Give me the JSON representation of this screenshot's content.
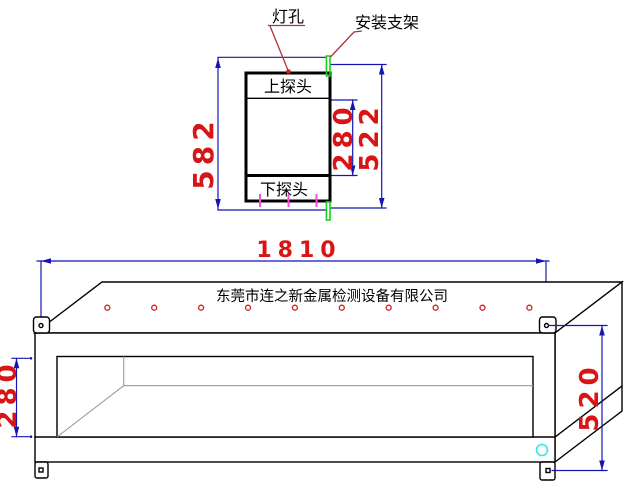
{
  "section_view": {
    "labels": {
      "lamp_hole": "灯孔",
      "mounting_bracket": "安装支架",
      "upper_probe": "上探头",
      "lower_probe": "下探头"
    },
    "dimensions": {
      "overall_height": "582",
      "mount_span": "522",
      "probe_spacing": "280"
    }
  },
  "perspective_view": {
    "company_name": "东莞市连之新金属检测设备有限公司",
    "dimensions": {
      "overall_length": "1810",
      "tunnel_height": "280",
      "overall_height": "520"
    },
    "lamp_hole_count": 10
  },
  "colors": {
    "dimension_line": "#1515b5",
    "dimension_text": "#d91414",
    "leader_line": "#b03434",
    "outline": "#000000",
    "interior_line": "#9a9a9a",
    "bracket_mark": "#19d119",
    "tick_mark": "#f050e0",
    "lamp_hole": "#cc2020",
    "detail_circle": "#30e8e8",
    "background": "#ffffff"
  }
}
